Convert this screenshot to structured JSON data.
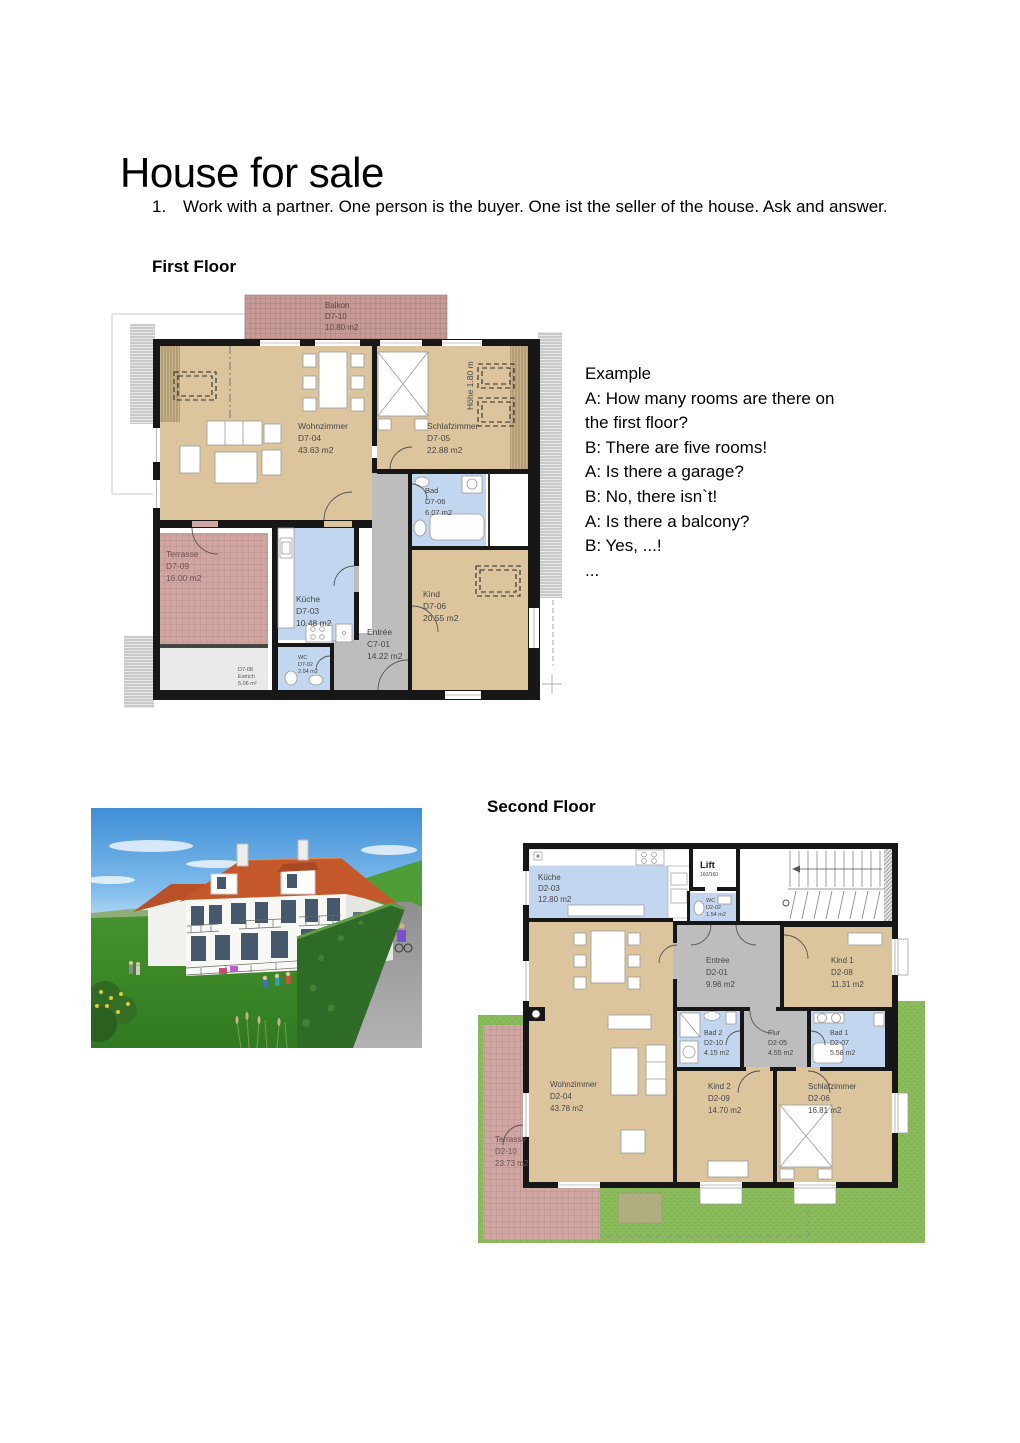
{
  "title": "House for sale",
  "instruction": {
    "number": "1.",
    "text": "Work with a partner. One person is the buyer. One ist the seller of the house. Ask and answer."
  },
  "sections": {
    "first_floor": "First Floor",
    "second_floor": "Second Floor"
  },
  "example": {
    "lines": [
      "Example",
      "A: How many rooms are there on",
      "the first floor?",
      "B: There are five rooms!",
      "A: Is there a garage?",
      "B: No, there isn`t!",
      "A: Is there a balcony?",
      "B: Yes, ...!",
      "..."
    ]
  },
  "first_floor_plan": {
    "height_note": "Höhe 1.80 m",
    "rooms": [
      {
        "name": "Balkon",
        "code": "D7-10",
        "area": "10.80 m2"
      },
      {
        "name": "Wohnzimmer",
        "code": "D7-04",
        "area": "43.63 m2"
      },
      {
        "name": "Schlafzimmer",
        "code": "D7-05",
        "area": "22.88 m2"
      },
      {
        "name": "Bad",
        "code": "D7-06",
        "area": "6.07 m2"
      },
      {
        "name": "Terrasse",
        "code": "D7-09",
        "area": "16.00 m2"
      },
      {
        "name": "Küche",
        "code": "D7-03",
        "area": "10.48 m2"
      },
      {
        "name": "Entrée",
        "code": "C7-01",
        "area": "14.22 m2"
      },
      {
        "name": "Kind",
        "code": "D7-06",
        "area": "20.55 m2"
      },
      {
        "name": "WC",
        "code": "D7-02",
        "area": "2.04 m2"
      },
      {
        "name": "D7-08",
        "code": "Estrich",
        "area": "5.06 m²"
      }
    ]
  },
  "second_floor_plan": {
    "rooms": [
      {
        "name": "Küche",
        "code": "D2-03",
        "area": "12.80 m2"
      },
      {
        "name": "Lift",
        "code": "160/160",
        "area": ""
      },
      {
        "name": "WC",
        "code": "D2-02",
        "area": "1.54 m2"
      },
      {
        "name": "Entrée",
        "code": "D2-01",
        "area": "9.96 m2"
      },
      {
        "name": "Kind 1",
        "code": "D2-08",
        "area": "11.31 m2"
      },
      {
        "name": "Wohnzimmer",
        "code": "D2-04",
        "area": "43.78 m2"
      },
      {
        "name": "Bad 2",
        "code": "D2-10",
        "area": "4.15 m2"
      },
      {
        "name": "Flur",
        "code": "D2-05",
        "area": "4.55 m2"
      },
      {
        "name": "Bad 1",
        "code": "D2-07",
        "area": "5.58 m2"
      },
      {
        "name": "Kind 2",
        "code": "D2-09",
        "area": "14.70 m2"
      },
      {
        "name": "Schlafzimmer",
        "code": "D2-06",
        "area": "16.81 m2"
      },
      {
        "name": "Terrasse",
        "code": "D2-10",
        "area": "23.73 m2"
      }
    ]
  },
  "colors": {
    "wall": "#171717",
    "room_tan": "#dcc59d",
    "room_blue": "#c2d6ef",
    "room_gray": "#bdbdbd",
    "terrace_pink": "#cfa6a2",
    "lawn_green": "#8abc5c",
    "roof_orange": "#c4582b"
  }
}
